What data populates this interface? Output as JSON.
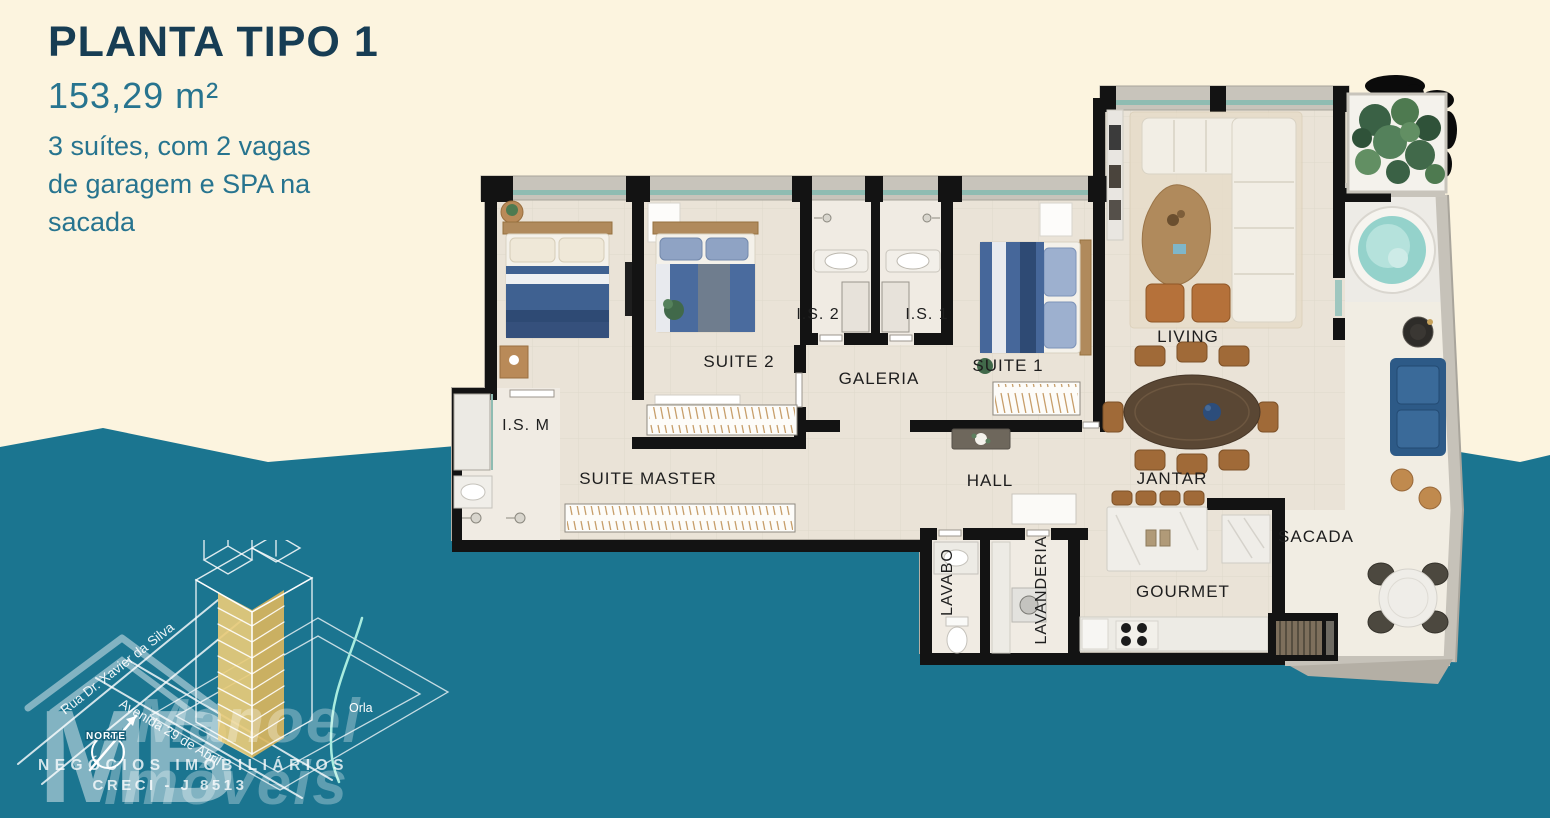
{
  "header": {
    "title": "PLANTA TIPO 1",
    "area": "153,29 m²",
    "description_lines": [
      "3 suítes, com 2 vagas",
      "de garagem e SPA na",
      "sacada"
    ]
  },
  "plan": {
    "labels": {
      "suite_master": "SUITE MASTER",
      "ism": "I.S. M",
      "suite2": "SUITE 2",
      "is2": "I.S. 2",
      "is1": "I.S. 1",
      "galeria": "GALERIA",
      "suite1": "SUITE 1",
      "living": "LIVING",
      "hall": "HALL",
      "jantar": "JANTAR",
      "lavabo": "LAVABO",
      "lavanderia": "LAVANDERIA",
      "gourmet": "GOURMET",
      "sacada": "SACADA"
    }
  },
  "branding": {
    "logo_initials": "MB",
    "watermark_line1": "Manoel",
    "watermark_line2": "Imóveis",
    "tagline": "NEGÓCIOS IMOBILIÁRIOS",
    "creci": "CRECI - J 8513",
    "compass_label": "NORTE"
  },
  "map": {
    "street1": "Rua Dr. Xavier da Silva",
    "street2": "Avenida 29 de Abril",
    "shore_label": "Orla"
  },
  "colors": {
    "background_cream": "#FCF4DF",
    "wave_teal": "#1B7590",
    "title_navy": "#173D54",
    "accent_teal": "#27748F"
  }
}
